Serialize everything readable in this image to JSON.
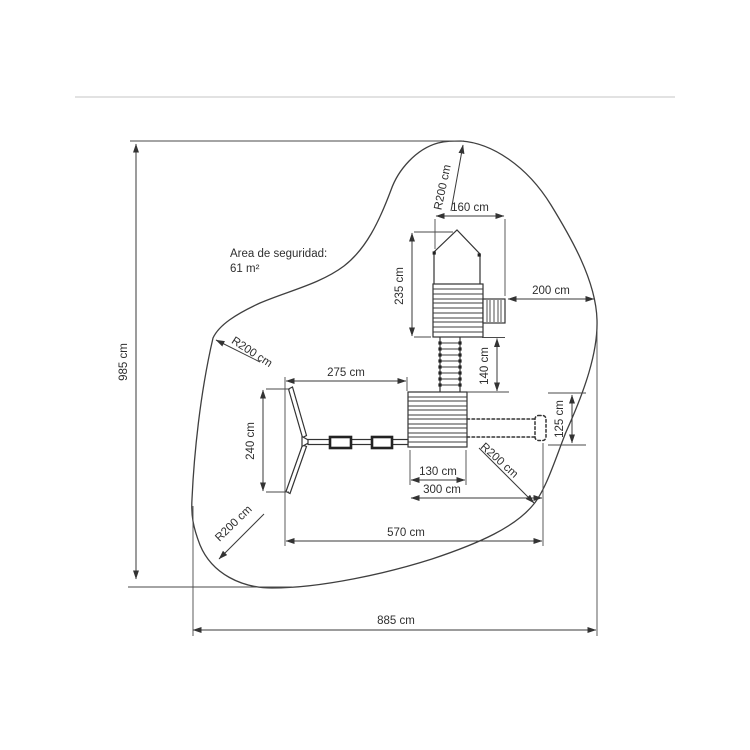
{
  "diagram": {
    "area": {
      "line1": "Area de seguridad:",
      "line2": "61 m²"
    },
    "dims": {
      "total_height": "985 cm",
      "total_width": "885 cm",
      "tower_width": "160 cm",
      "tower_height": "235 cm",
      "clearance_right": "200 cm",
      "ladder_length": "140 cm",
      "swing_span": "275 cm",
      "swing_depth": "240 cm",
      "deck_width": "130 cm",
      "deck_plus_slide": "300 cm",
      "overall_span": "570 cm",
      "slide_clearance": "125 cm",
      "radius": "R200 cm"
    }
  }
}
